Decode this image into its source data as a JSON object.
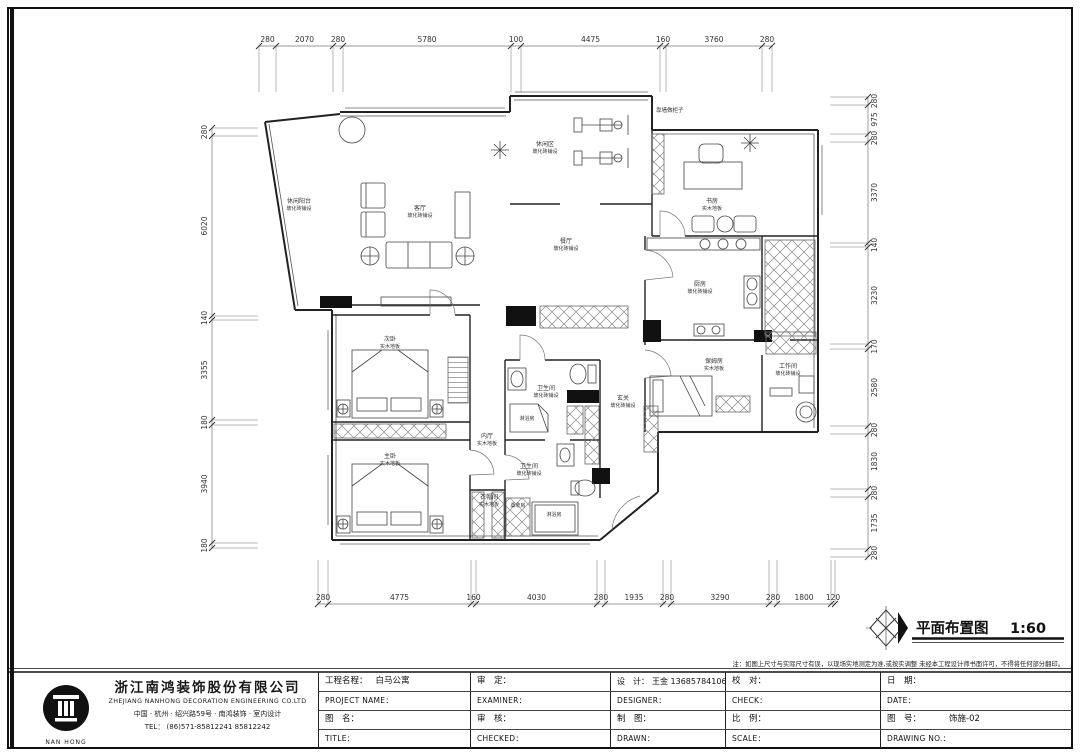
{
  "caption": {
    "title": "平面布置图",
    "scale": "1:60"
  },
  "note": "注：如图上尺寸与实际尺寸有误，以现场实地测定为准,或按实调整 未经本工程设计师书面许可，不得将任何部分翻印。",
  "company": {
    "name_cn": "浙江南鸿装饰股份有限公司",
    "name_en": "ZHEJIANG NANHONG DECORATION ENGINEERING CO.LTD",
    "address": "中国 · 杭州 · 绍兴路59号 · 南鸿装饰 · 室内设计",
    "tel": "TEL： (86)571-85812241 85812242",
    "logo_caption": "NAN HONG"
  },
  "titleblock": {
    "project_label": "工程名程：",
    "project_value": "白马公寓",
    "project_en": "PROJECT NAME：",
    "sheet_label": "图　名：",
    "sheet_en": "TITLE：",
    "examine_label": "审　定：",
    "examine_en": "EXAMINER：",
    "review_label": "审　核：",
    "review_en": "CHECKED：",
    "design_label": "设　计：",
    "design_value": "王金 13685784106",
    "design_en": "DESIGNER：",
    "draft_label": "制　图：",
    "draft_en": "DRAWN：",
    "proof_label": "校　对：",
    "proof_en": "CHECK：",
    "scale_label": "比　例：",
    "scale_en": "SCALE：",
    "date_label": "日　期：",
    "date_en": "DATE：",
    "number_label": "图　号：",
    "number_value": "饰施-02",
    "number_en": "DRAWING NO.："
  },
  "dimensions": {
    "top": [
      "280",
      "2070",
      "280",
      "5780",
      "100",
      "4475",
      "160",
      "3760",
      "280"
    ],
    "bottom": [
      "280",
      "4775",
      "160",
      "4030",
      "280",
      "1935",
      "280",
      "3290",
      "280",
      "1800",
      "120"
    ],
    "left": [
      "280",
      "6020",
      "140",
      "3355",
      "180",
      "3940",
      "180"
    ],
    "right": [
      "280",
      "975",
      "280",
      "3370",
      "140",
      "3230",
      "170",
      "2580",
      "280",
      "1830",
      "280",
      "1735",
      "280"
    ]
  },
  "rooms": [
    {
      "name": "休闲阳台",
      "finish": "玻化砖铺设"
    },
    {
      "name": "客厅",
      "finish": "玻化砖铺设"
    },
    {
      "name": "休闲区",
      "finish": "玻化砖铺设"
    },
    {
      "name": "书房",
      "finish": "实木地板"
    },
    {
      "name": "餐厅",
      "finish": "玻化砖铺设"
    },
    {
      "name": "厨房",
      "finish": "玻化砖铺设"
    },
    {
      "name": "保姆房",
      "finish": "实木地板"
    },
    {
      "name": "工作间",
      "finish": "玻化砖铺设"
    },
    {
      "name": "次卧",
      "finish": "实木地板"
    },
    {
      "name": "主卧",
      "finish": "实木地板"
    },
    {
      "name": "内厅",
      "finish": "实木地板"
    },
    {
      "name": "衣帽间",
      "finish": "实木地板"
    },
    {
      "name": "卫生间",
      "finish": "玻化砖铺设"
    },
    {
      "name": "卫生间",
      "finish": "玻化砖铺设"
    },
    {
      "name": "玄关",
      "finish": "玻化砖铺设"
    }
  ],
  "annotations": {
    "cabinet_note": "靠墙做柜子",
    "shower_1": "淋浴房",
    "shower_2": "淋浴房",
    "sauna": "桑拿房"
  },
  "colors": {
    "ink": "#1a1a1a",
    "wall": "#222222",
    "furniture": "#444444",
    "dim": "#555555"
  }
}
